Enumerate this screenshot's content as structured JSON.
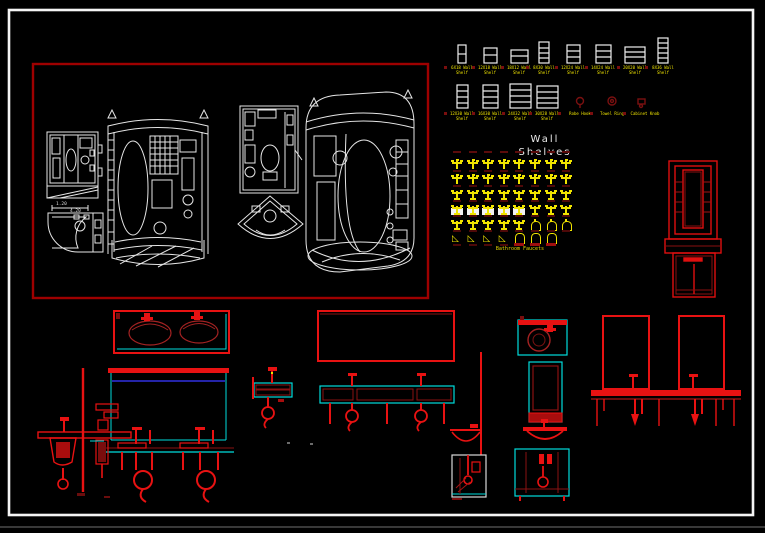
{
  "scene": {
    "background": "#000000",
    "page_border_color": "#ffffff"
  },
  "palette": {
    "red": "#e81212",
    "dark_red": "#8a1212",
    "cyan": "#00dcdc",
    "yellow": "#f0e400",
    "white": "#e8e8e8",
    "navy": "#2424a8"
  },
  "wall_shelves": {
    "title": "Wall Shelves",
    "row1_labels": [
      {
        "l1": "6X18 Wall",
        "l2": "Shelf"
      },
      {
        "l1": "12X18 Wall",
        "l2": "Shelf"
      },
      {
        "l1": "18X12 Wall",
        "l2": "Shelf"
      },
      {
        "l1": "8X30 Wall",
        "l2": "Shelf"
      },
      {
        "l1": "12X24 Wall",
        "l2": "Shelf"
      },
      {
        "l1": "14X24 Wall",
        "l2": "Shelf"
      },
      {
        "l1": "20X20 Wall",
        "l2": "Shelf"
      },
      {
        "l1": "8X36 Wall",
        "l2": "Shelf"
      }
    ],
    "row2_labels": [
      {
        "l1": "12X30 Wall",
        "l2": "Shelf"
      },
      {
        "l1": "16X30 Wall",
        "l2": "Shelf"
      },
      {
        "l1": "24X32 Wall",
        "l2": "Shelf"
      },
      {
        "l1": "30X28 Wall",
        "l2": "Shelf"
      }
    ],
    "accessories": [
      {
        "label": "Robe Hook"
      },
      {
        "label": "Towel Ring"
      },
      {
        "label": "Cabinet Knob"
      }
    ]
  },
  "faucet_chart": {
    "caption": "Bathroom Faucets",
    "row_counts": [
      8,
      8,
      8,
      8,
      8,
      7
    ]
  },
  "shower_frame": {
    "dim1": "1.20",
    "dim2": "4.20"
  }
}
